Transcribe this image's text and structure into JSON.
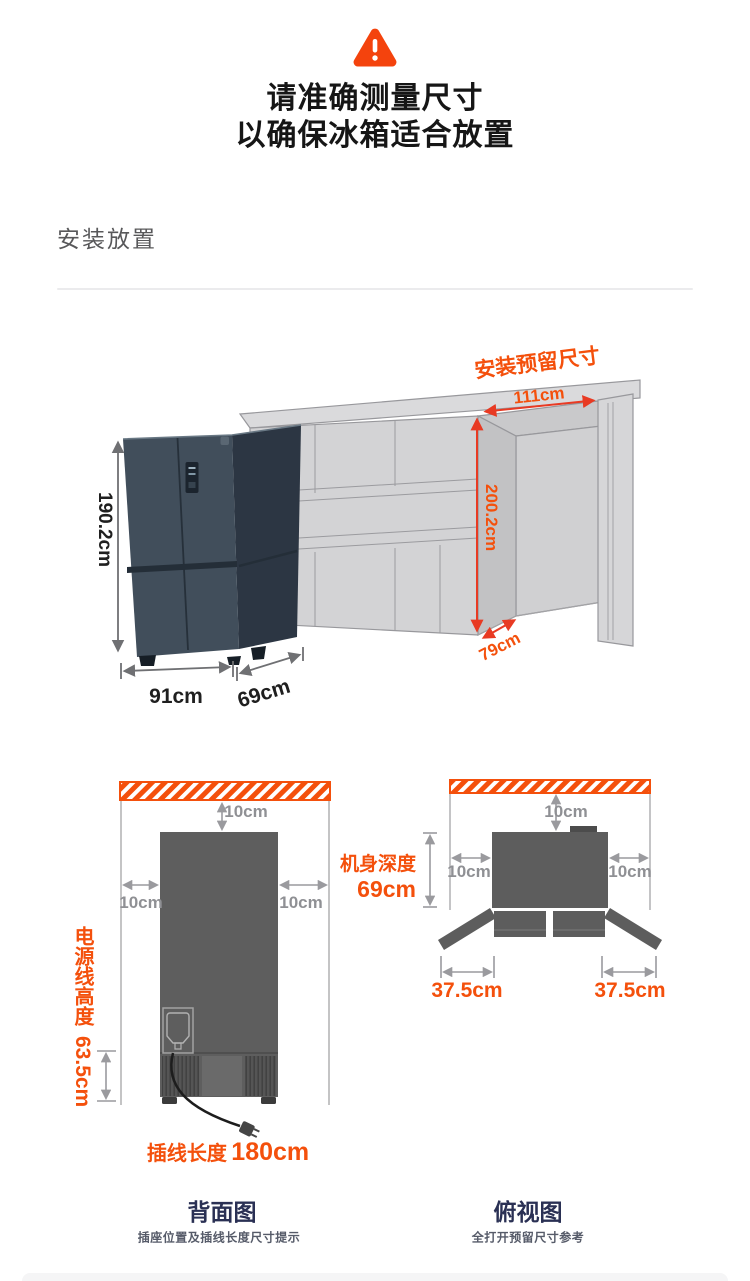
{
  "header": {
    "icon": "warning-triangle-icon",
    "line1": "请准确测量尺寸",
    "line2": "以确保冰箱适合放置"
  },
  "section": {
    "title": "安装放置"
  },
  "install_diagram": {
    "reserve_label": "安装预留尺寸",
    "niche_width": "111cm",
    "niche_height": "200.2cm",
    "niche_depth": "79cm",
    "fridge_height": "190.2cm",
    "fridge_width": "91cm",
    "fridge_depth": "69cm"
  },
  "back_view": {
    "clearance_top": "10cm",
    "clearance_left": "10cm",
    "clearance_right": "10cm",
    "power_cord_label": "电源线高度",
    "power_cord_value": "63.5cm",
    "plug_label": "插线长度",
    "plug_value": "180cm",
    "caption": "背面图",
    "caption_sub": "插座位置及插线长度尺寸提示"
  },
  "top_view": {
    "clearance_top": "10cm",
    "clearance_left": "10cm",
    "clearance_right": "10cm",
    "depth_label": "机身深度",
    "depth_value": "69cm",
    "door_clearance_left": "37.5cm",
    "door_clearance_right": "37.5cm",
    "caption": "俯视图",
    "caption_sub": "全打开预留尺寸参考"
  },
  "colors": {
    "accent_orange": "#f4500c",
    "dim_red": "#e83a23",
    "dim_gray": "#8f9094",
    "dim_dark": "#1f1f1f",
    "caption_navy": "#2a3054"
  }
}
